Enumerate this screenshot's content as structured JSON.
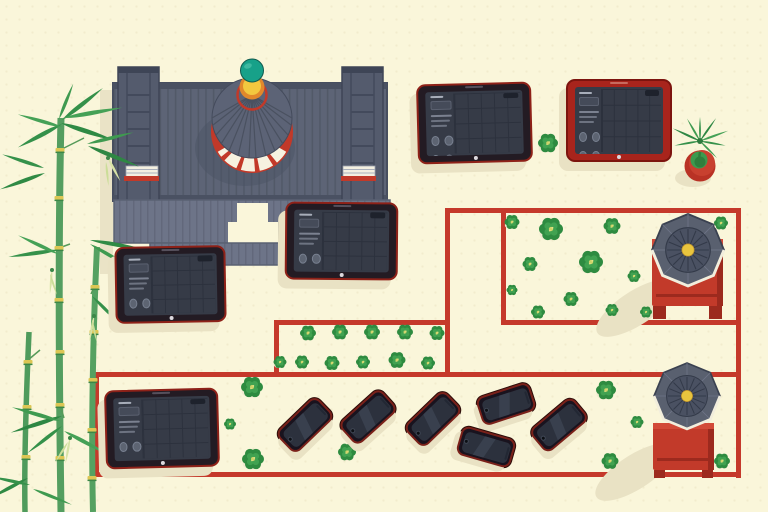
{
  "scene": {
    "name": "top-down-temple-courtyard-illustration",
    "background": "#faf6da",
    "colors": {
      "path_red": "#c5392b",
      "red_dark": "#9c2a1e",
      "red_bright": "#d24a38",
      "table_red": "#c23a2a",
      "roof": "#5d6476",
      "roof_dark": "#474e5f",
      "roof_light": "#878da0",
      "teal_finial": "#17a189",
      "gold": "#f2c83f",
      "orange": "#e1882b",
      "leaf_green": "#2e8b40",
      "leaf_light": "#41a251",
      "bamboo_green": "#549e60",
      "pale_bud": "#d8e3a6",
      "shadow": "#e9e2c4",
      "bezel_dark": "#231b23",
      "bezel_red": "#a8241c",
      "screen_slate": "#363b47"
    },
    "red_path": {
      "thickness": 5,
      "segments": [
        [
          447,
          208,
          292,
          5
        ],
        [
          736,
          208,
          5,
          270
        ],
        [
          445,
          208,
          5,
          168
        ],
        [
          501,
          208,
          5,
          116
        ],
        [
          501,
          320,
          240,
          5
        ],
        [
          274,
          320,
          176,
          5
        ],
        [
          274,
          320,
          5,
          56
        ],
        [
          94,
          372,
          647,
          5
        ],
        [
          94,
          372,
          5,
          105
        ],
        [
          94,
          472,
          647,
          5
        ]
      ]
    },
    "tablets": [
      {
        "x": 417,
        "y": 83,
        "w": 111,
        "h": 76,
        "rot": -1.5,
        "bezel": "dark"
      },
      {
        "x": 566,
        "y": 79,
        "w": 102,
        "h": 79,
        "rot": 0,
        "bezel": "red"
      },
      {
        "x": 285,
        "y": 202,
        "w": 109,
        "h": 74,
        "rot": 0.5,
        "bezel": "dark"
      },
      {
        "x": 115,
        "y": 246,
        "w": 107,
        "h": 73,
        "rot": -1,
        "bezel": "dark"
      },
      {
        "x": 105,
        "y": 389,
        "w": 110,
        "h": 75,
        "rot": -1.5,
        "bezel": "dark"
      }
    ],
    "phone_size": {
      "w": 52,
      "h": 26
    },
    "phones": [
      {
        "x": 303,
        "y": 423,
        "rot": -44
      },
      {
        "x": 366,
        "y": 415,
        "rot": -42
      },
      {
        "x": 431,
        "y": 417,
        "rot": -44
      },
      {
        "x": 504,
        "y": 402,
        "rot": -18
      },
      {
        "x": 484,
        "y": 445,
        "rot": 16
      },
      {
        "x": 557,
        "y": 423,
        "rot": -40
      }
    ],
    "pavilions": [
      {
        "cx": 688,
        "cy": 250,
        "roof_r": 36,
        "table": {
          "x": -36,
          "y": -11,
          "w": 71,
          "h": 67
        },
        "legs": {
          "y": 56,
          "h": 13,
          "w": 13
        }
      },
      {
        "cx": 687,
        "cy": 396,
        "roof_r": 33,
        "table": {
          "x": -34,
          "y": 27,
          "w": 61,
          "h": 47
        },
        "legs": {
          "y": 74,
          "h": 8,
          "w": 11
        }
      }
    ],
    "plants": [
      [
        548,
        143,
        20
      ],
      [
        512,
        222,
        15
      ],
      [
        551,
        229,
        24
      ],
      [
        612,
        226,
        17
      ],
      [
        721,
        223,
        14
      ],
      [
        530,
        264,
        15
      ],
      [
        591,
        262,
        24
      ],
      [
        634,
        276,
        13
      ],
      [
        512,
        290,
        11
      ],
      [
        571,
        299,
        15
      ],
      [
        538,
        312,
        14
      ],
      [
        612,
        310,
        13
      ],
      [
        646,
        312,
        12
      ],
      [
        308,
        333,
        16
      ],
      [
        340,
        332,
        16
      ],
      [
        372,
        332,
        16
      ],
      [
        405,
        332,
        16
      ],
      [
        437,
        333,
        15
      ],
      [
        280,
        362,
        13
      ],
      [
        302,
        362,
        14
      ],
      [
        332,
        363,
        15
      ],
      [
        363,
        362,
        14
      ],
      [
        397,
        360,
        17
      ],
      [
        428,
        363,
        14
      ],
      [
        252,
        387,
        22
      ],
      [
        230,
        424,
        12
      ],
      [
        253,
        459,
        22
      ],
      [
        347,
        452,
        18
      ],
      [
        606,
        390,
        20
      ],
      [
        637,
        422,
        13
      ],
      [
        610,
        461,
        17
      ],
      [
        722,
        461,
        16
      ]
    ],
    "potted_plant": {
      "cx": 700,
      "cy": 166
    }
  }
}
